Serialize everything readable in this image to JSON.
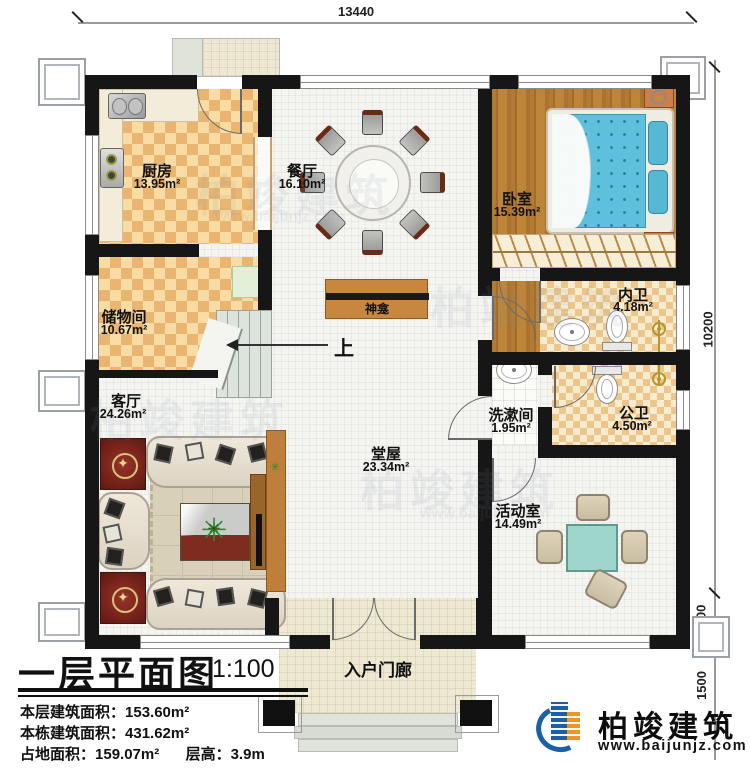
{
  "title": {
    "main": "一层平面图",
    "scale": "1:100"
  },
  "stats": {
    "s1_label": "本层建筑面积：",
    "s1_value": "153.60m²",
    "s2_label": "本栋建筑面积：",
    "s2_value": "431.62m²",
    "s3_label": "占地面积：",
    "s3_value": "159.07m²",
    "s4_label": "层高：",
    "s4_value": "3.9m"
  },
  "dimensions": {
    "top": "13440",
    "right_total": "10200",
    "right_900": "900",
    "right_1500": "1500"
  },
  "rooms": [
    {
      "name": "厨房",
      "area": "13.95m²"
    },
    {
      "name": "餐厅",
      "area": "16.10m²"
    },
    {
      "name": "卧室",
      "area": "15.39m²"
    },
    {
      "name": "储物间",
      "area": "10.67m²"
    },
    {
      "name": "内卫",
      "area": "4.18m²"
    },
    {
      "name": "洗漱间",
      "area": "1.95m²"
    },
    {
      "name": "公卫",
      "area": "4.50m²"
    },
    {
      "name": "客厅",
      "area": "24.26m²"
    },
    {
      "name": "堂屋",
      "area": "23.34m²"
    },
    {
      "name": "活动室",
      "area": "14.49m²"
    },
    {
      "name": "入户门廊",
      "area": ""
    }
  ],
  "labels": {
    "shrine": "神龛",
    "stairs_up": "上"
  },
  "logo": {
    "company": "柏竣建筑",
    "site": "www.baijunjz.com"
  },
  "watermark": {
    "text": "柏竣建筑",
    "site": "www.baijunjz.com"
  },
  "colors": {
    "wall": "#161616",
    "checker": "#e9b571",
    "wood": "#b27b33",
    "bed": "#5fc0de",
    "logo_blue": "#1a5fa8",
    "logo_orange": "#f29422"
  }
}
